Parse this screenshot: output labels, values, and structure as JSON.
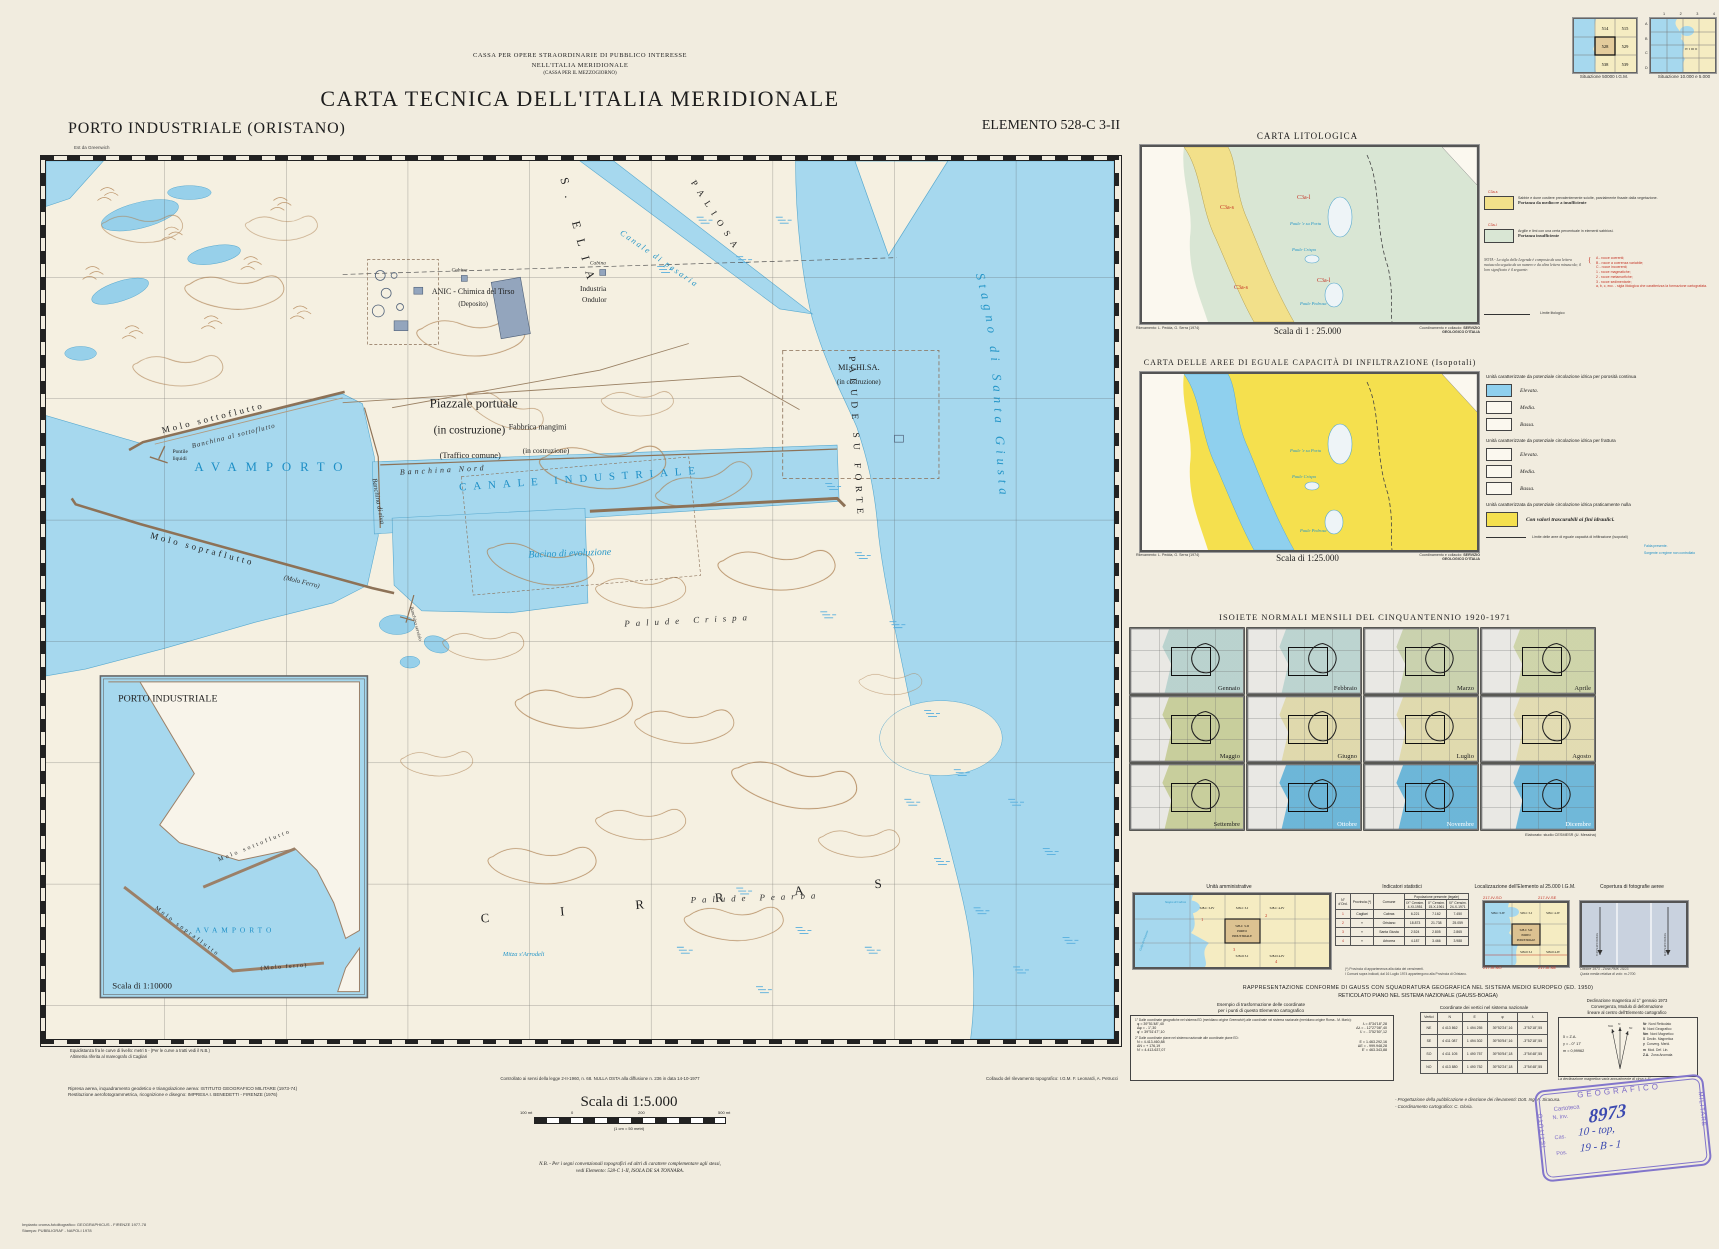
{
  "page": {
    "org1": "CASSA PER OPERE STRAORDINARIE DI PUBBLICO INTERESSE",
    "org2": "NELL'ITALIA MERIDIONALE",
    "org3": "(CASSA PER IL MEZZOGIORNO)",
    "title": "CARTA TECNICA DELL'ITALIA MERIDIONALE",
    "sheet": "PORTO INDUSTRIALE (ORISTANO)",
    "element": "ELEMENTO  528-C 3-II",
    "greenwich": "Est da Greenwich"
  },
  "index_maps": {
    "igm_caption": "Situazione 50000 I.G.M.",
    "igm": {
      "c1": "514",
      "c2": "515",
      "c3": "528",
      "c4": "529",
      "c5": "538",
      "c6": "539"
    },
    "sit2_caption": "Situazione 10.000 e 5.000",
    "cols": {
      "c1": "1",
      "c2": "2",
      "c3": "3",
      "c4": "4"
    },
    "rows": {
      "r1": "A",
      "r2": "B",
      "r3": "C",
      "r4": "D"
    },
    "quad": "IV I III II"
  },
  "map": {
    "labels": {
      "s_elia": "S. ELIA",
      "paliosa": "PALIOSA",
      "canale_pesaria": "Canale di pesaria",
      "palude_su_forte": "PALUDE SU FORTE",
      "stagno": "Stagno di Santa Giusta",
      "avamporto": "AVAMPORTO",
      "canale_industriale": "CANALE INDUSTRIALE",
      "bacino": "Bacino di evoluzione",
      "banchina_nord": "Banchina Nord",
      "banchina_riva": "Banchina di riva",
      "banchina_servizio": "Banchina servizio",
      "molo_sottoflutto": "Molo sottoflutto",
      "banchina_sottoflutto": "Banchina al sottoflutto",
      "molo_sopraflutto": "Molo sopraflutto",
      "molo_ferro": "(Molo Ferro)",
      "pontile1": "Pontile",
      "pontile2": "liquidi",
      "anic1": "ANIC - Chimica del Tirso",
      "anic2": "(Deposito)",
      "industria1": "Industria",
      "industria2": "Ondulor",
      "michisa1": "MI.CHI.SA.",
      "michisa2": "(in costruzione)",
      "piazzale1": "Piazzale portuale",
      "piazzale2": "(in costruzione)",
      "piazzale3": "(Traffico comune)",
      "fabbrica1": "Fabbrica mangimi",
      "fabbrica2": "(in costruzione)",
      "palude_crispa": "Palude Crispa",
      "palude_pearba": "Palude Pearba",
      "cirras": "CIRRAS",
      "mitza": "Mitza s'Arrodeli",
      "ruderi": "Ruderi",
      "cabina": "Cabina"
    },
    "inset": {
      "title": "PORTO INDUSTRIALE",
      "scale": "Scala di 1:10000",
      "molo_sottoflutto": "Molo sottoflutto",
      "avamporto": "AVAMPORTO",
      "molo_sopraflutto": "Molo sopraflutto",
      "molo_ferro": "(Molo ferro)"
    },
    "notes": {
      "equi1": "Equidistanza fra le curve di livello: metri 5 - (Per le curve a tratti vedi il N.B.)",
      "equi2": "Altimetria riferita al mareografo di Cagliari",
      "nulla_osta": "Controllato ai sensi della legge 2-II-1960, n. 68. NULLA OSTA alla diffusione n. 236 in data 14-10-1977",
      "collaudo": "Collaudo del rilevamento topografico: I.G.M.  F. Leonardi, A. Petrucci"
    }
  },
  "litologica": {
    "title": "CARTA LITOLOGICA",
    "scale": "Scala di 1 : 25.000",
    "rilev1": "Rilevamento: L. Pedda,",
    "rilev2": "G. Serra (1974)",
    "coord1": "Coordinamento e collaudo:",
    "coord2": "SERVIZIO GEOLOGICO D'ITALIA",
    "code_s": "C3a-s",
    "code_l": "C3a-l",
    "paule1": "Paule 'e su Portu",
    "paule2": "Paule Crispa",
    "paule3": "Paule Pedrosa",
    "item1_text": "Sabbie e dune costiere prevalentemente sciolte, parzialmente fissate dalla vegetazione.",
    "item1_bold": "Portanza da mediocre a insufficiente",
    "item2_text": "Argille e limi con una certa percentuale in elementi sabbiosi.",
    "item2_bold": "Portanza insufficiente",
    "nota": "NOTA - La sigla della Legenda è composta da una lettera maiuscola seguita da un numero e da altra lettera minuscola; il loro significato è il seguente:",
    "n1": "A - rocce coerenti;",
    "n2": "B - rocce a coerenza variabile;",
    "n3": "C - rocce incoerenti;",
    "n4": "1 - rocce magmatiche;",
    "n5": "2 - rocce metamorfiche;",
    "n6": "3 - rocce sedimentarie;",
    "n7": "a, b, c, ecc. - sigla litologica che caratterizza la formazione cartografata.",
    "limite": "Limite litologico"
  },
  "infiltrazione": {
    "title": "CARTA DELLE AREE DI EGUALE CAPACITÀ DI INFILTRAZIONE (Isopotali)",
    "scale": "Scala di 1:25.000",
    "sec1": "Unità caratterizzate da potenziale circolazione idrica per porosità continua",
    "sec2": "Unità caratterizzate da potenziale circolazione idrica per frattura",
    "sec3": "Unità caratterizzata da potenziale circolazione idrica praticamente nulla",
    "elevata": "Elevata.",
    "media": "Media.",
    "bassa": "Bassa.",
    "nulla_item": "Con valori trascurabili ai fini idraulici.",
    "limite": "Limite delle aree di eguale capacità di infiltrazione (isopotali)",
    "blue1": "Falda presente.",
    "blue2": "Sorgente o regime non controllato",
    "rilev1": "Rilevamento: L. Pedda,",
    "rilev2": "G. Serra (1974)",
    "coord1": "Coordinamento e collaudo:",
    "coord2": "SERVIZIO GEOLOGICO D'ITALIA"
  },
  "isoiete": {
    "title": "ISOIETE NORMALI MENSILI DEL CINQUANTENNIO 1920-1971",
    "credit": "Elaborato: studio CESMESR (U. Messina)",
    "months": [
      {
        "label": "Gennaio",
        "color": "#c2e1dc"
      },
      {
        "label": "Febbraio",
        "color": "#c6e3de"
      },
      {
        "label": "Marzo",
        "color": "#d6e0b4"
      },
      {
        "label": "Aprile",
        "color": "#dde4ae"
      },
      {
        "label": "Maggio",
        "color": "#d4db9d"
      },
      {
        "label": "Giugno",
        "color": "#f1e9b2"
      },
      {
        "label": "Luglio",
        "color": "#f2eab4"
      },
      {
        "label": "Agosto",
        "color": "#f4ecb9"
      },
      {
        "label": "Settembre",
        "color": "#d4db9d"
      },
      {
        "label": "Ottobre",
        "color": "#62bee8"
      },
      {
        "label": "Novembre",
        "color": "#62bee8"
      },
      {
        "label": "Dicembre",
        "color": "#66c0e9"
      }
    ]
  },
  "panels": {
    "admin": {
      "title": "Unità amministrative",
      "cells": {
        "tl": "528-C 3-IV",
        "tm": "528-C 3-I",
        "tr": "528-C 4-IV",
        "c1": "528-C 3-II",
        "c2": "PORTO",
        "c3": "INDUSTRIALE",
        "bm": "528-D 3-I",
        "br": "528-D 4-IV"
      },
      "nums": [
        "1",
        "2",
        "3",
        "4"
      ],
      "sea1": "Stagno di Cabras",
      "sea2": "Golfo di Oristano"
    },
    "stats": {
      "title": "Indicatori statistici",
      "group": "Popolazione presente (legale)",
      "h_ord": "N° d'Ord.",
      "h_prov": "Provincia (*)",
      "h_com": "Comune",
      "h_c1": "IX° Censim. 4-XI-1951",
      "h_c2": "X° Censim. 15-X-1961",
      "h_c3": "XI° Censim. 24-X-1971",
      "rows": [
        [
          "1",
          "Cagliari",
          "Cabras",
          "6.221",
          "7.162",
          "7.450"
        ],
        [
          "2",
          "»",
          "Oristano",
          "18.873",
          "21.738",
          "25.059"
        ],
        [
          "3",
          "»",
          "Santa Giusta",
          "2.524",
          "2.805",
          "2.865"
        ],
        [
          "4",
          "»",
          "Arborea",
          "4.187",
          "3.466",
          "3.988"
        ]
      ],
      "fn1": "(*) Provincia di appartenenza alla data dei censimenti.",
      "fn2": "I Comuni sopra indicati, dal 16 Luglio 1974 appartengono alla Provincia di Oristano."
    },
    "loc": {
      "title": "Localizzazione dell'Elemento al 25.000 I.G.M.",
      "c_tl": "217-IV-SO",
      "c_tr": "217-IV-SE",
      "c_bl": "217-III-NO",
      "c_br": "217-III-NE",
      "cells": {
        "tl": "528-C 3-IV",
        "tm": "528-C 3-I",
        "tr": "528-C 4-IV",
        "c1": "528-C 3-II",
        "c2": "PORTO",
        "c3": "INDUSTRIALE",
        "bm": "528-D 3-I",
        "br": "528-D 4-IV"
      }
    },
    "photo": {
      "title": "Copertura di fotografie aeree",
      "strip1": "STRISCIATA 69 A",
      "strip2": "STRISCIATA 69 B",
      "note1": "Ottobre 1973 - Zona RMK 15/23.",
      "note2": "Quota media relativa di volo: m 2700."
    }
  },
  "gauss": {
    "t1": "RAPPRESENTAZIONE CONFORME DI GAUSS CON SQUADRATURA GEOGRAFICA NEL SISTEMA MEDIO EUROPEO (ED. 1950)",
    "t2": "RETICOLATO PIANO NEL SISTEMA NAZIONALE (GAUSS-BOAGA)",
    "es1": "Esempio di trasformazione delle coordinate",
    "es2": "per i punti di questo Elemento cartografico",
    "b1h": "1° Dalle coordinate geografiche nel sistema ED (meridiano origine Greenwich) alle coordinate nel sistema nazionale (meridiano origine Roma - M. Mario):",
    "b1r1a": "φ =  39°51'48\",40",
    "b1r1b": "λ =  8°34'18\",28",
    "b1r2a": "Δφ =  - 1\",30",
    "b1r2b": "Δλ =  - 12°27'08\",40",
    "b1r3a": "φ' =  39°51'47\",10",
    "b1r3b": "λ' =  - 3°52'50\",12",
    "b2h": "2° Dalle coordinate piane nel sistema nazionale alle coordinate piane ED:",
    "b2r1a": "N =  4.413.460,88",
    "b2r1b": "E =  1.463.292,16",
    "b2r2a": "ΔN =  + 176,19",
    "b2r2b": "ΔE =  - 999.948,28",
    "b2r3a": "N' =  4.413.637,07",
    "b2r3b": "E' =  463.343,88",
    "coord_title": "Coordinate dei vertici nel sistema nazionale",
    "ch": [
      "Vertici",
      "N",
      "E",
      "φ",
      "λ"
    ],
    "crows": [
      [
        "NE",
        "4 413 862",
        "1 494 255",
        "39°52'24\",16",
        "-3°52'18\",55"
      ],
      [
        "SE",
        "4 411 087",
        "1 494 302",
        "39°50'54\",16",
        "-3°52'18\",55"
      ],
      [
        "SO",
        "4 411 105",
        "1 490 757",
        "39°50'54\",18",
        "-3°54'48\",55"
      ],
      [
        "NO",
        "4 413 880",
        "1 490 752",
        "39°52'24\",18",
        "-3°54'48\",55"
      ]
    ],
    "d1": "Declinazione magnetica al 1° gennaio 1973",
    "d2": "Convergenza, Modulo di deformazione",
    "d3": "lineare al centro dell'Elemento cartografico",
    "v1": "δ =  Z.A.",
    "v2": "γ =  - 0° 17'",
    "v3": "m =  0,99962",
    "l1a": "Nr",
    "l1b": "Nord Reticolato",
    "l2a": "N",
    "l2b": "Nord Geografico",
    "l3a": "Nm",
    "l3b": "Nord Magnetico",
    "l4a": "δ",
    "l4b": "Declin. Magnetica",
    "l5a": "γ",
    "l5b": "Converg. Merid.",
    "l6a": "m",
    "l6b": "Mod. Def. Lin.",
    "l7a": "Z.A.",
    "l7b": "Zona Anomala",
    "dnote": "La declinazione magnetica varia annualmente di circa + 6'.",
    "fn1": "- Progettazione della pubblicazione e direzione dei rilevamenti: Dott. Ing. A. Siracusa.",
    "fn2": "- Coordinamento cartografico: C. Gloria."
  },
  "scalebar": {
    "title": "Scala di 1:5.000",
    "left": "100 mt",
    "zero": "0",
    "mid": "200",
    "right": "500 mt",
    "sub": "(1 cm = 50 metri)",
    "nb1": "N.B. - Per i segni convenzionali topografici ed altri di carattere complementare agli stessi,",
    "nb2": "vedi Elemento: 528-C 1-II, ISOLA DE SA TONNARA."
  },
  "credits": {
    "c1": "Ripresa aerea, inquadramento geodetico e triangolazione aerea: ISTITUTO GEOGRAFICO MILITARE (1973-74)",
    "c2": "Restituzione aerofotogrammetrica, ricognizione e disegno: IMPRESA I. BENEDETTI - FIRENZE (1976)",
    "p1": "Impianto croma-fotolitografico: GEOGRAPHICUS - FIRENZE 1977-78",
    "p2": "Stampa: PUBBLIGRAF - NAPOLI 1978"
  },
  "stamp": {
    "inst": "ISTITUTO",
    "geo": "GEOGRAFICO",
    "mil": "MILITARE",
    "cartoteca": "Cartoteca",
    "ninv": "N. Inv.",
    "num": "8973",
    "cas": "Cas.",
    "casv": "10 - top,",
    "pos": "Pos.",
    "posv": "19 - B - 1"
  },
  "colors": {
    "water": "#a6d8ee",
    "sand": "#f2e08a",
    "clay": "#d9e6d4",
    "infblue": "#8fd0ee",
    "infyellow": "#f5e04e"
  }
}
